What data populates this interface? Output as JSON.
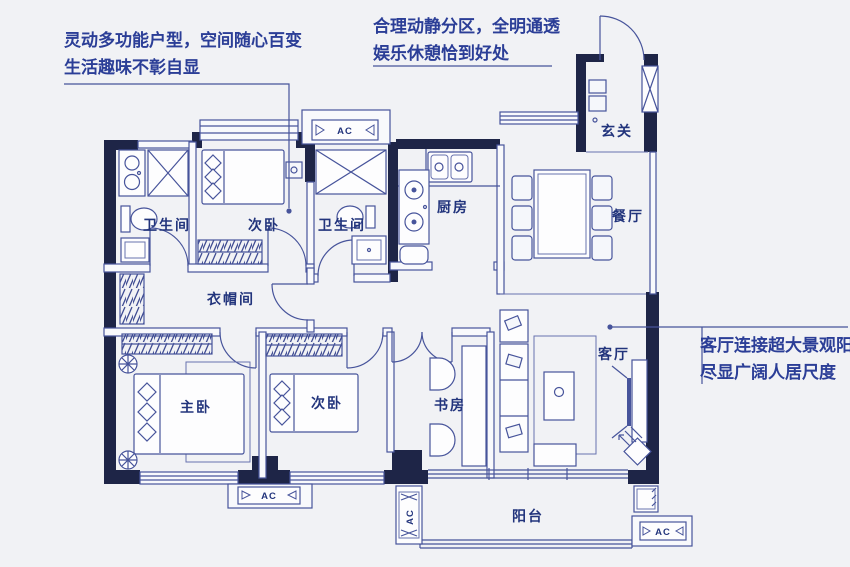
{
  "annotations": {
    "top_left": {
      "line1": "灵动多功能户型，空间随心百变",
      "line2": "生活趣味不彰自显"
    },
    "top_center": {
      "line1": "合理动静分区，全明通透",
      "line2": "娱乐休憩恰到好处"
    },
    "right": {
      "line1": "客厅连接超大景观阳台",
      "line2": "尽显广阔人居尺度"
    }
  },
  "rooms": {
    "entry": "玄关",
    "bath1": "卫生间",
    "bath2": "卫生间",
    "bedroom1": "次卧",
    "bedroom2": "次卧",
    "kitchen": "厨房",
    "dining": "餐厅",
    "cloakroom": "衣帽间",
    "master": "主卧",
    "study": "书房",
    "living": "客厅",
    "balcony": "阳台"
  },
  "labels": {
    "ac": "AC"
  },
  "colors": {
    "background": "#f1f2f5",
    "wall": "#1e2547",
    "line": "#47549b",
    "text": "#2b3e97"
  }
}
